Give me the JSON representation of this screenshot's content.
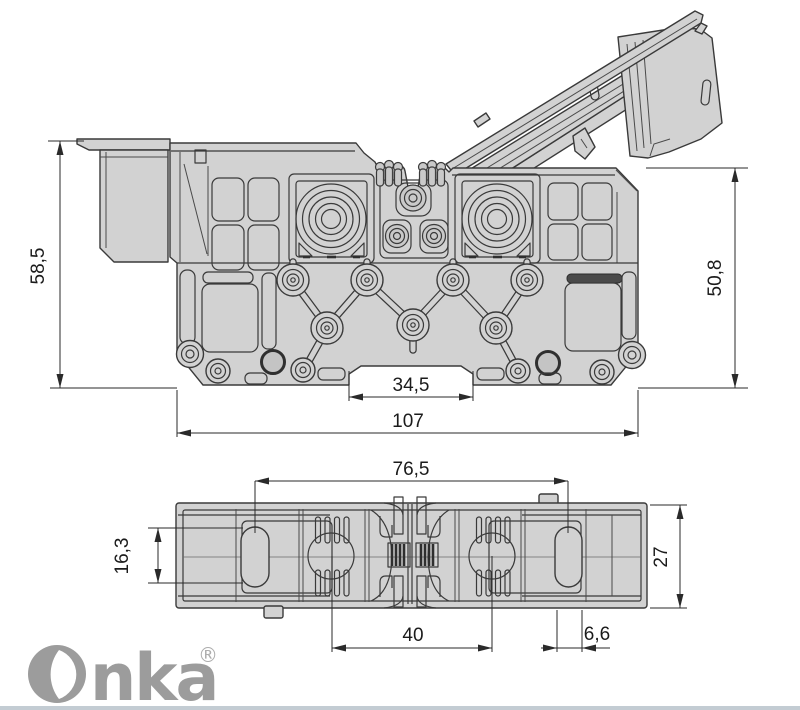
{
  "page": {
    "background": "#ffffff",
    "footer_rule_color": "#c3ccd3"
  },
  "brand": {
    "name": "Onka",
    "wordmark_suffix": "nka",
    "registered_mark": "®",
    "color": "#9c9c9c"
  },
  "drawing": {
    "type": "technical-dimension-drawing",
    "colors": {
      "part_fill": "#d2d2d2",
      "outline": "#3a3a3a",
      "dimension": "#1b1b1b"
    },
    "views": [
      {
        "id": "side-view",
        "dimensions": [
          {
            "name": "overall-height-left",
            "value": "58,5"
          },
          {
            "name": "body-height-right",
            "value": "50,8"
          },
          {
            "name": "din-notch-width",
            "value": "34,5"
          },
          {
            "name": "overall-length",
            "value": "107"
          }
        ]
      },
      {
        "id": "top-view",
        "dimensions": [
          {
            "name": "mounting-hole-spacing",
            "value": "76,5"
          },
          {
            "name": "end-slot-length",
            "value": "16,3"
          },
          {
            "name": "overall-depth",
            "value": "27"
          },
          {
            "name": "clamp-center-spacing",
            "value": "40"
          },
          {
            "name": "mounting-slot-width",
            "value": "6,6"
          }
        ]
      }
    ]
  }
}
